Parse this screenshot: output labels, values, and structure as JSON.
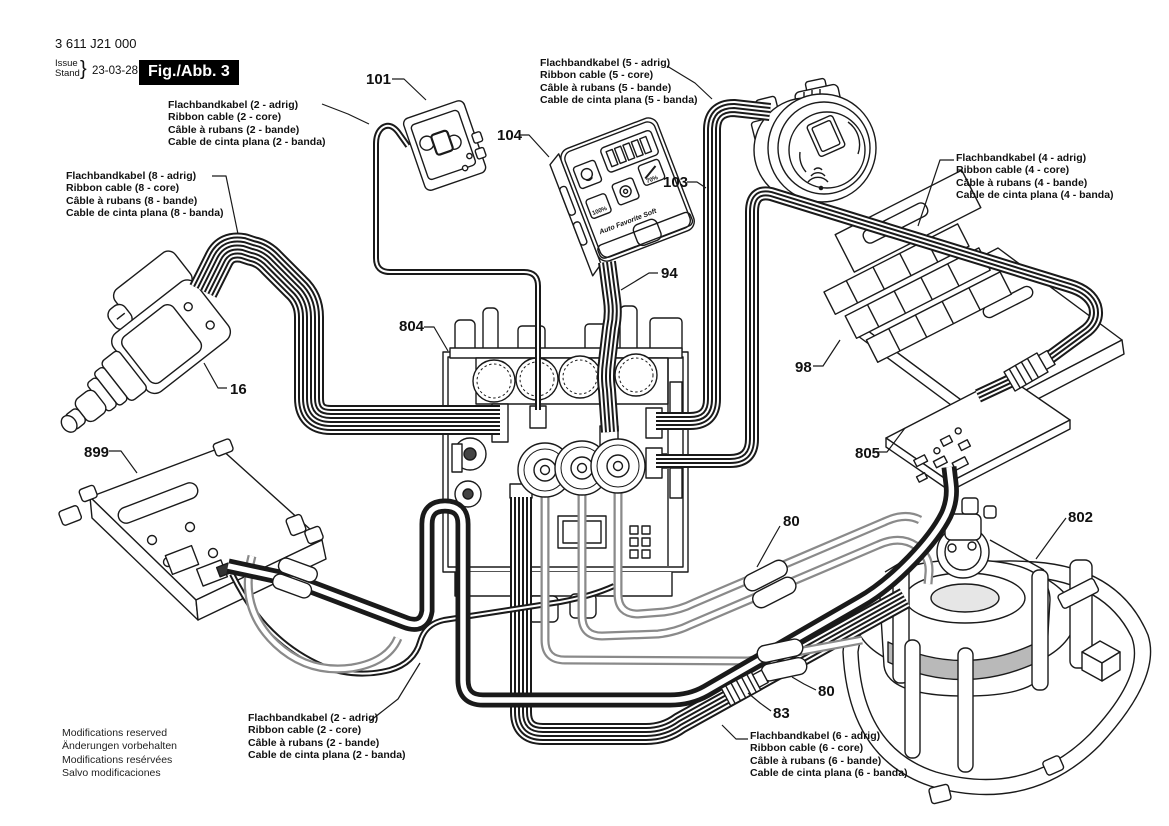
{
  "header": {
    "part_number": "3 611 J21 000",
    "issue_label": "Issue",
    "stand_label": "Stand",
    "brace": "}",
    "date": "23-03-28",
    "figure_label": "Fig./Abb. 3"
  },
  "footer": {
    "lines": [
      "Modifications reserved",
      "Änderungen vorbehalten",
      "Modifications resérvées",
      "Salvo modificaciones"
    ]
  },
  "cable_labels": {
    "two_core_top": {
      "lines": [
        "Flachbandkabel (2 - adrig)",
        "Ribbon cable (2 - core)",
        "Câble à rubans (2 - bande)",
        "Cable de cinta plana (2 - banda)"
      ]
    },
    "five_core": {
      "lines": [
        "Flachbandkabel (5 - adrig)",
        "Ribbon cable (5 - core)",
        "Câble à rubans (5 - bande)",
        "Cable de cinta plana (5 - banda)"
      ]
    },
    "eight_core": {
      "lines": [
        "Flachbandkabel (8 - adrig)",
        "Ribbon cable (8 - core)",
        "Câble à rubans (8 - bande)",
        "Cable de cinta plana (8 - banda)"
      ]
    },
    "four_core": {
      "lines": [
        "Flachbandkabel (4 - adrig)",
        "Ribbon cable (4 - core)",
        "Câble à rubans (4 - bande)",
        "Cable de cinta plana (4 - banda)"
      ]
    },
    "two_core_bottom": {
      "lines": [
        "Flachbandkabel (2 - adrig)",
        "Ribbon cable (2 - core)",
        "Câble à rubans (2 - bande)",
        "Cable de cinta plana (2 - banda)"
      ]
    },
    "six_core": {
      "lines": [
        "Flachbandkabel (6 - adrig)",
        "Ribbon cable (6 - core)",
        "Câble à rubans (6 - bande)",
        "Cable de cinta plana (6 - banda)"
      ]
    }
  },
  "callouts": {
    "p101": "101",
    "p104": "104",
    "p103": "103",
    "p94": "94",
    "p804": "804",
    "p16": "16",
    "p98": "98",
    "p805": "805",
    "p899": "899",
    "p80a": "80",
    "p80b": "80",
    "p83": "83",
    "p802": "802"
  },
  "remote": {
    "modes": "Auto Favorite Soft",
    "level_100": "100%",
    "level_70": "70%"
  },
  "colors": {
    "line": "#1a1a1a",
    "gray_cable": "#8a8a8a",
    "background": "#ffffff"
  }
}
